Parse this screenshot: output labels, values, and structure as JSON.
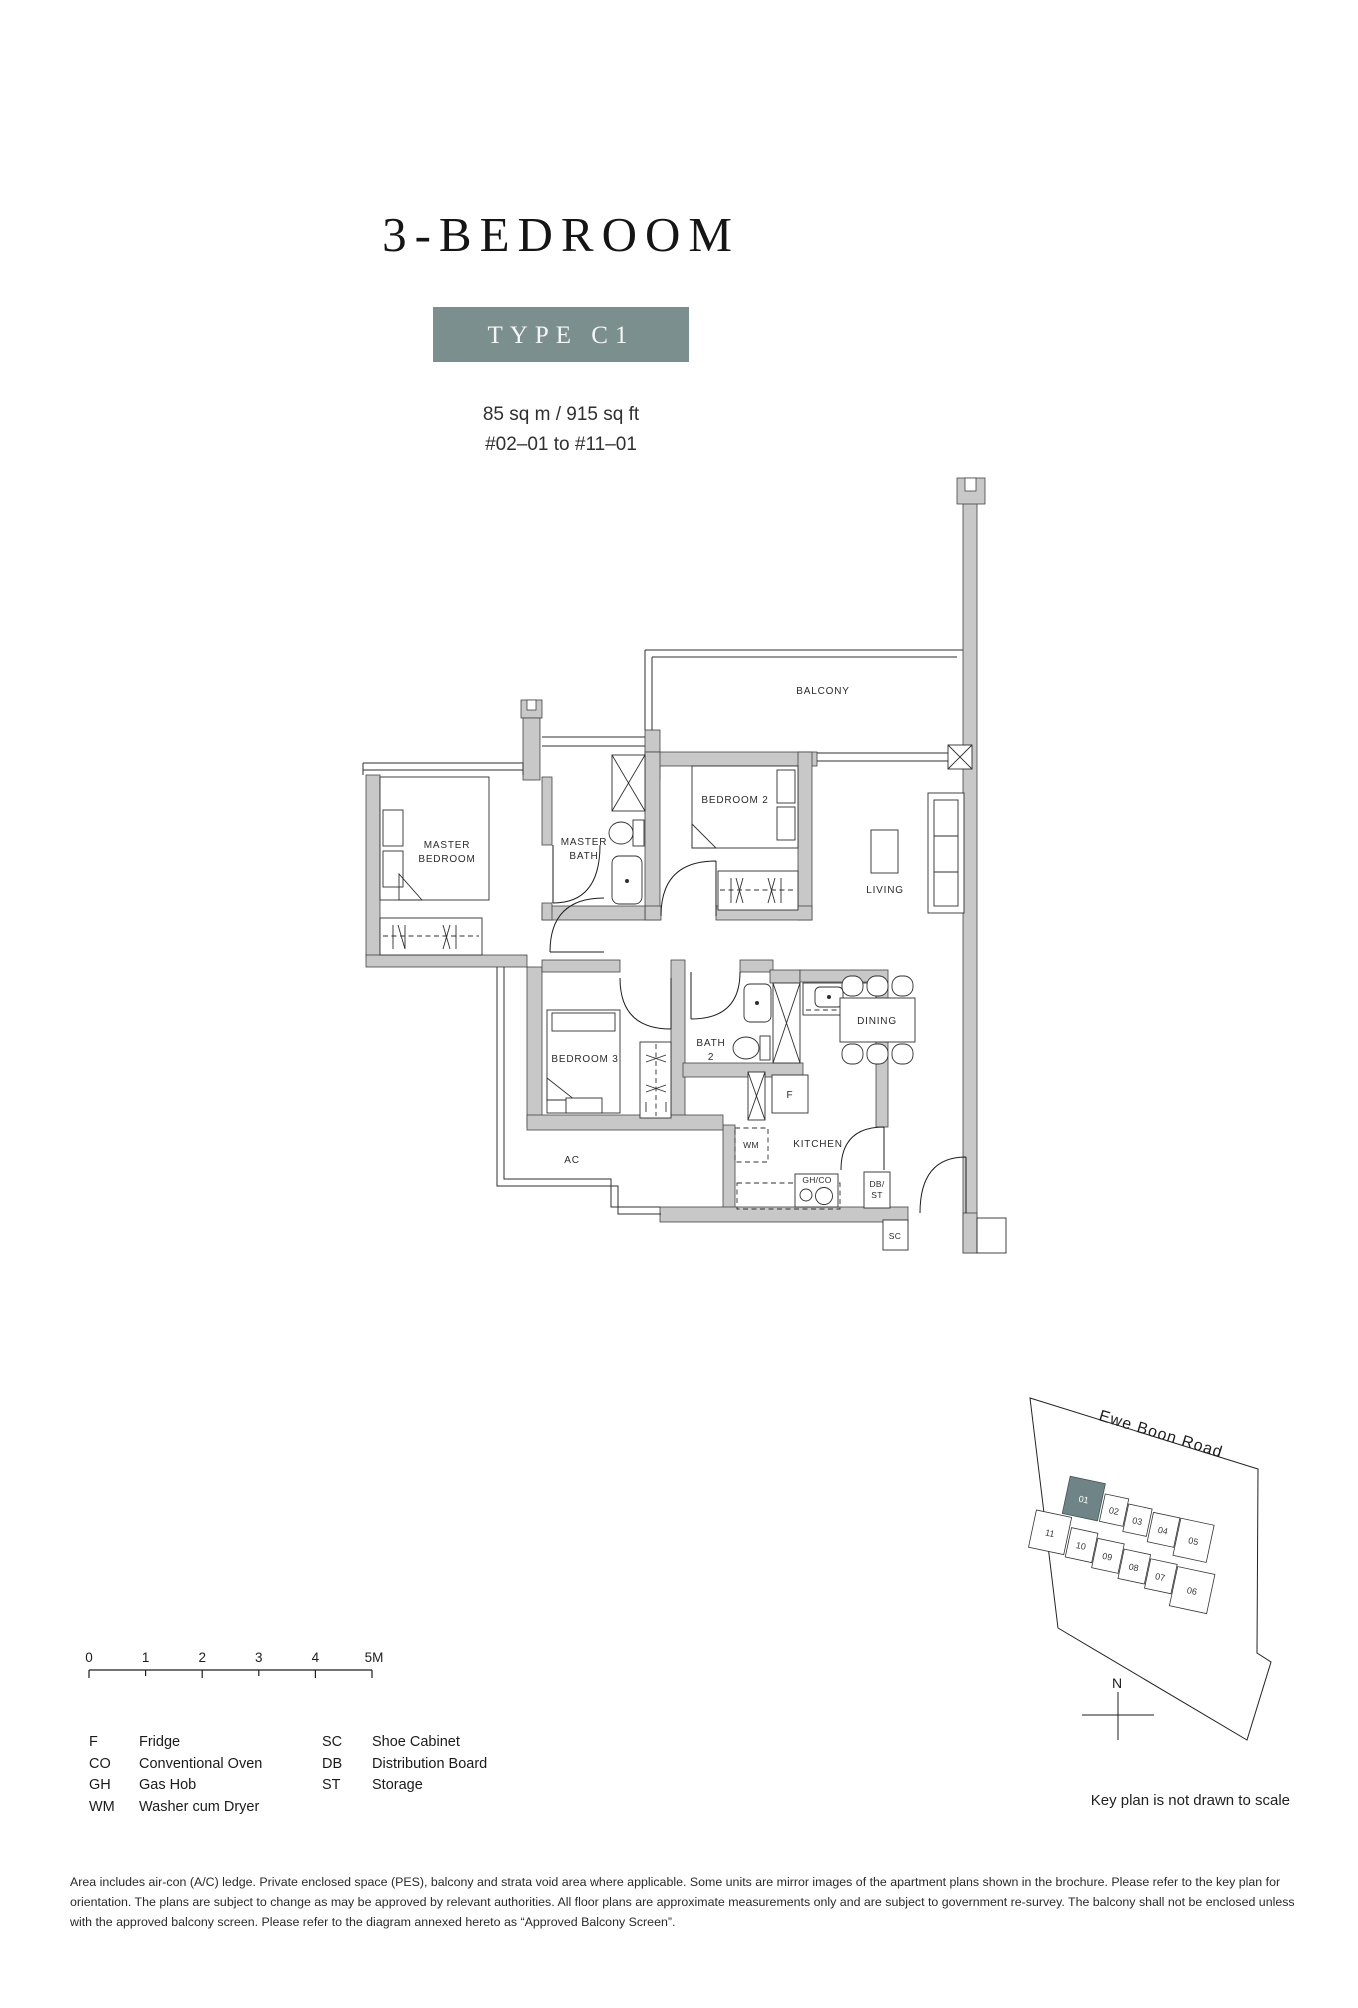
{
  "header": {
    "title": "3-BEDROOM",
    "type_badge": "TYPE C1",
    "area": "85 sq m / 915 sq ft",
    "units_range": "#02–01 to #11–01"
  },
  "colors": {
    "badge_teal": "#7C8F8F",
    "wall_gray": "#C8C8C8",
    "keyplan_highlight": "#6F8487"
  },
  "floorplan": {
    "labels": {
      "balcony": "BALCONY",
      "master_bedroom_l1": "MASTER",
      "master_bedroom_l2": "BEDROOM",
      "master_bath_l1": "MASTER",
      "master_bath_l2": "BATH",
      "bedroom2": "BEDROOM 2",
      "bedroom3": "BEDROOM 3",
      "bath2_l1": "BATH",
      "bath2_l2": "2",
      "living": "LIVING",
      "dining": "DINING",
      "kitchen": "KITCHEN",
      "ac": "AC",
      "fridge": "F",
      "washer": "WM",
      "hob": "GH/CO",
      "db_l1": "DB/",
      "db_l2": "ST",
      "shoe_cabinet": "SC"
    }
  },
  "scalebar": {
    "ticks": [
      "0",
      "1",
      "2",
      "3",
      "4",
      "5M"
    ]
  },
  "legend": {
    "left": [
      {
        "abbr": "F",
        "label": "Fridge"
      },
      {
        "abbr": "CO",
        "label": "Conventional Oven"
      },
      {
        "abbr": "GH",
        "label": "Gas Hob"
      },
      {
        "abbr": "WM",
        "label": "Washer cum Dryer"
      }
    ],
    "right": [
      {
        "abbr": "SC",
        "label": "Shoe Cabinet"
      },
      {
        "abbr": "DB",
        "label": "Distribution Board"
      },
      {
        "abbr": "ST",
        "label": "Storage"
      }
    ]
  },
  "keyplan": {
    "road": "Ewe Boon Road",
    "north": "N",
    "note": "Key plan is not drawn to scale",
    "units": [
      "01",
      "02",
      "03",
      "04",
      "05",
      "06",
      "07",
      "08",
      "09",
      "10",
      "11"
    ],
    "highlighted_unit": "01"
  },
  "disclaimer": "Area includes air-con (A/C) ledge. Private enclosed space (PES), balcony and strata void area where applicable. Some units are mirror images of the apartment plans shown in the brochure. Please refer to the key plan for orientation. The plans are subject to change as may be approved by relevant authorities. All floor plans are approximate measurements only and are subject to government re-survey. The balcony shall not be enclosed unless with the approved balcony screen. Please refer to the diagram annexed hereto as “Approved Balcony Screen”."
}
